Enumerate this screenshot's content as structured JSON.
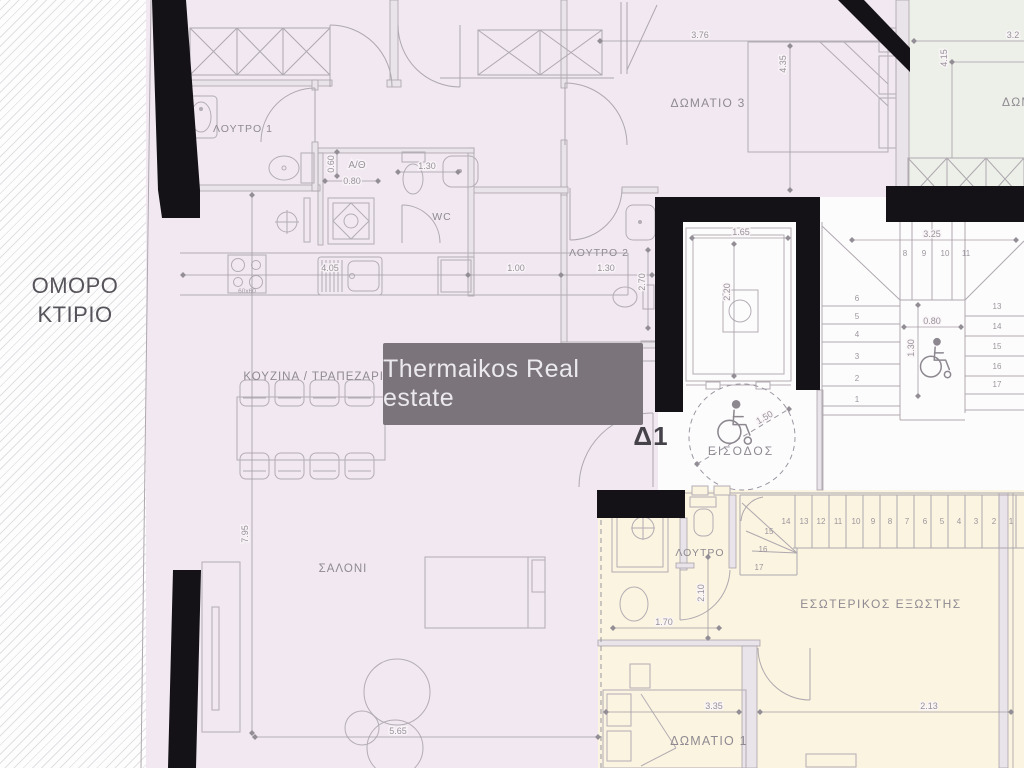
{
  "watermark": {
    "text": "Thermaikos Real estate"
  },
  "neighbor": {
    "line1": "ΟΜΟΡΟ",
    "line2": "ΚΤΙΡΙΟ"
  },
  "unit": {
    "label": "Δ1"
  },
  "labels": {
    "bathroom1": "ΛΟΥΤΡΟ 1",
    "bathroom2": "ΛΟΥΤΡΟ 2",
    "wc": "WC",
    "boiler": "A/Θ",
    "bedroom3": "ΔΩΜΑΤΙΟ 3",
    "bedroom_partial": "ΔΩΜ",
    "kitchen": "ΚΟΥΖΙΝΑ / ΤΡΑΠΕΖΑΡΙΑ",
    "living": "ΣΑΛΟΝΙ",
    "entrance": "ΕΙΣΟΔΟΣ",
    "bathroom_lower": "ΛΟΥΤΡΟ",
    "balcony": "ΕΣΩΤΕΡΙΚΟΣ ΕΞΩΣΤΗΣ",
    "bedroom1": "ΔΩΜΑΤΙΟ 1"
  },
  "dims": {
    "bedroom3_w": "3.76",
    "bedroom3_h": "4.35",
    "green_h": "4.15",
    "green_w": "3.2",
    "boiler_w": "0.80",
    "boiler_d": "0.60",
    "wc_w": "1.30",
    "kitchen_w": "4.05",
    "hall_w": "1.00",
    "bath2_w": "1.30",
    "bath2_h": "2.70",
    "elev_w": "1.65",
    "elev_h": "2.20",
    "stair_w": "3.25",
    "landing_w": "0.80",
    "landing_h": "1.30",
    "entry_d": "1.50",
    "living_h": "7.95",
    "living_w": "5.65",
    "bathL_h": "2.10",
    "bathL_w": "1.70",
    "bedroom1_w": "3.35",
    "room2_w": "2.13",
    "hob": "60x60"
  },
  "stairs": {
    "upper_left": [
      "1",
      "2",
      "3",
      "4",
      "5",
      "6"
    ],
    "upper_top": [
      "8",
      "9",
      "10",
      "11"
    ],
    "upper_right": [
      "13",
      "14",
      "15",
      "16",
      "17"
    ],
    "lower_run": [
      "14",
      "13",
      "12",
      "11",
      "10",
      "9",
      "8",
      "7",
      "6",
      "5",
      "4",
      "3",
      "2",
      "1"
    ],
    "lower_winder": [
      "15",
      "16",
      "17"
    ]
  },
  "colors": {
    "apartment_fill": "#f2e8f1",
    "lower_apartment_fill": "#fbf4e0",
    "adjacent_room_fill": "#edf0e9",
    "wall": "#141217",
    "line": "#aea8af",
    "label_text": "#8f8a92",
    "watermark_bg": "#7b757b",
    "watermark_text": "#ebe9ed"
  }
}
